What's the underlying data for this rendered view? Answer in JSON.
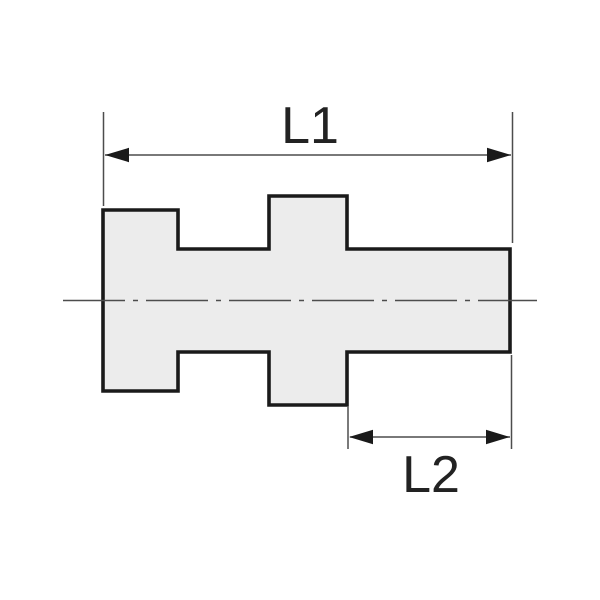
{
  "figure": {
    "kind": "engineering-dimension-drawing",
    "part_shape": "stepped fitting profile (side view)",
    "dimensions": [
      {
        "label": "L1"
      },
      {
        "label": "L2"
      }
    ],
    "colors": {
      "background": "#ffffff",
      "part_fill": "#ececec",
      "part_outline": "#1a1a1a",
      "thin_lines": "#4d4d4d",
      "arrowheads": "#1a1a1a",
      "label_text": "#222222"
    }
  }
}
